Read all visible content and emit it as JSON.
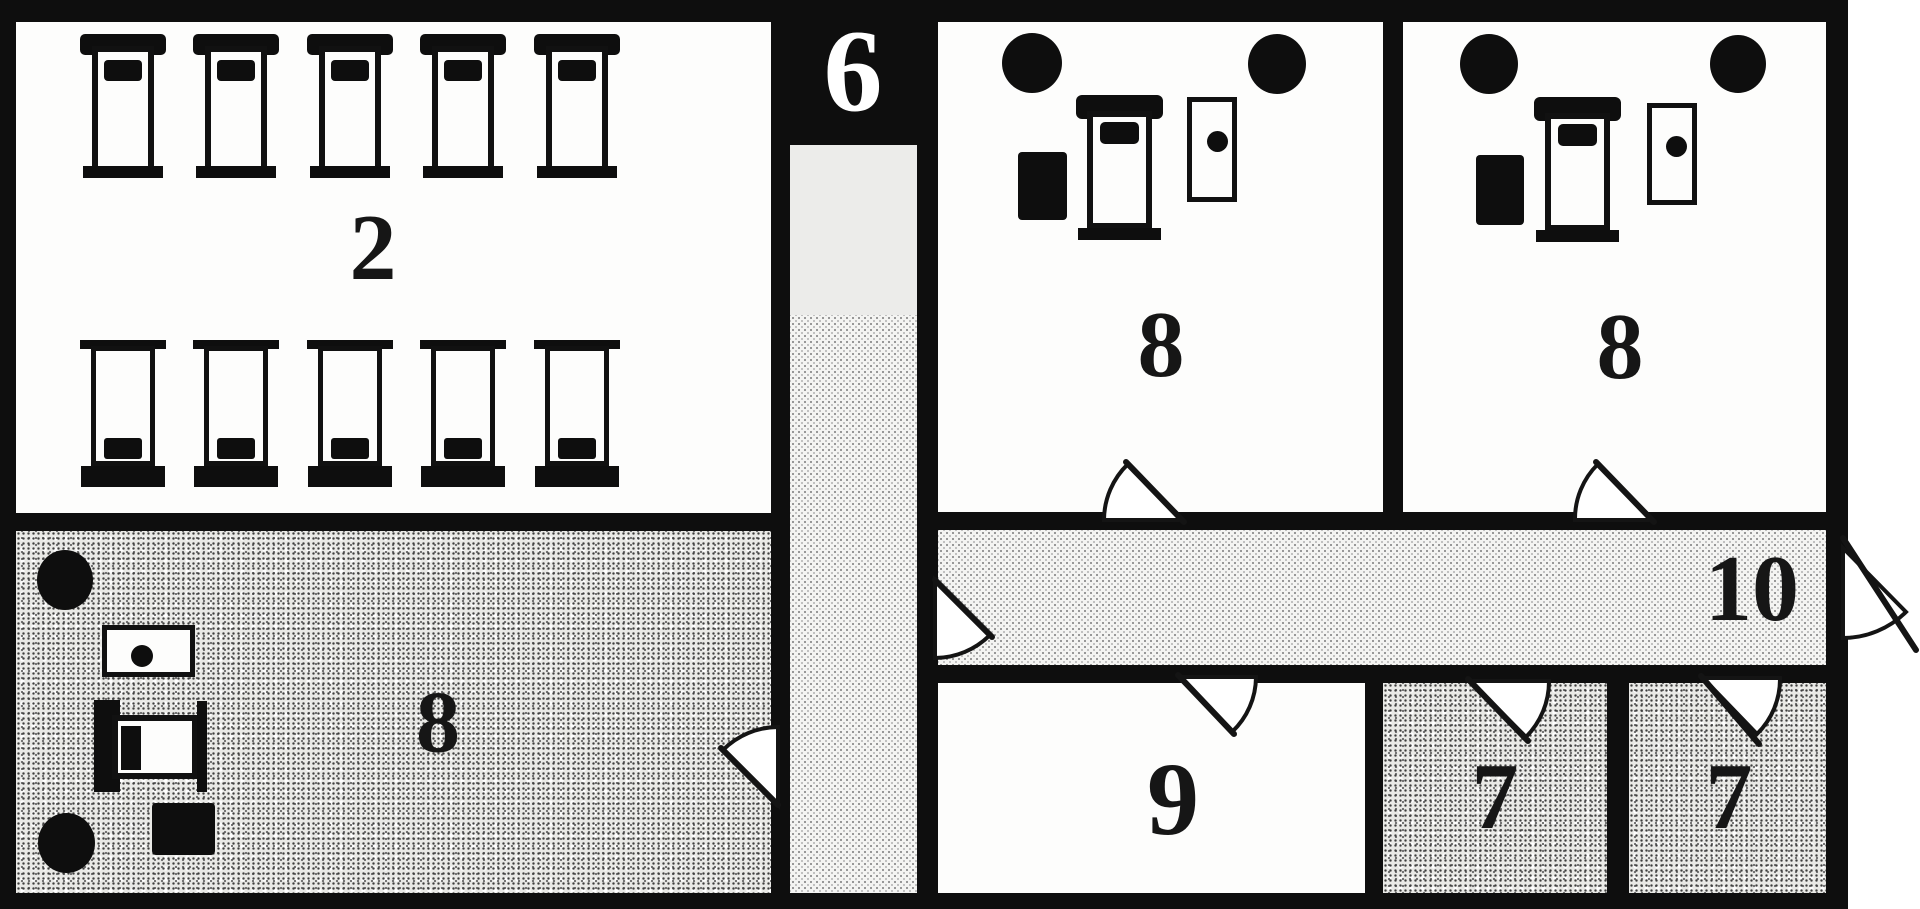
{
  "title": "barracks floor plan",
  "palette": {
    "wall": "#0e0e0e",
    "room_white": "#fdfdfc",
    "corridor_fill": "#f4f4f2",
    "stipple_fill": "#c9c9c6",
    "label_dark": "#161616",
    "label_on_black": "#ffffff"
  },
  "rooms": {
    "barracks": {
      "label": "2",
      "beds": {
        "rows": 2,
        "columns": 5
      }
    },
    "corridor_north": {
      "label": "6"
    },
    "quarters_mid": {
      "label": "8",
      "furniture": [
        "pillar-icon",
        "pillar-icon",
        "bed-icon",
        "chest-icon",
        "table-icon"
      ]
    },
    "quarters_right": {
      "label": "8",
      "furniture": [
        "pillar-icon",
        "pillar-icon",
        "bed-icon",
        "chest-icon",
        "table-icon"
      ]
    },
    "quarters_lower_left": {
      "label": "8",
      "furniture": [
        "pillar-icon",
        "pillar-icon",
        "bed-icon",
        "chest-icon",
        "table-icon"
      ]
    },
    "room_nine": {
      "label": "9"
    },
    "cell_left": {
      "label": "7"
    },
    "cell_right": {
      "label": "7"
    },
    "corridor_east": {
      "label": "10"
    }
  },
  "icons": {
    "bed-icon": "bed with headboard and pillow (outlined rectangle)",
    "pillar-icon": "solid black circle",
    "chest-icon": "solid black rectangle",
    "table-icon": "outlined rectangle with center dot",
    "door-swing-icon": "quarter-circle door swing arc"
  },
  "doors": {
    "count": 8,
    "locations": [
      "corridor-6 to lower-left room 8",
      "corridor-6 to corridor-10",
      "corridor-10 to middle room 8",
      "corridor-10 to room 9",
      "corridor-10 to right room 8",
      "corridor-10 east exit",
      "corridor-10 to left room 7",
      "corridor-10 to right room 7"
    ]
  }
}
